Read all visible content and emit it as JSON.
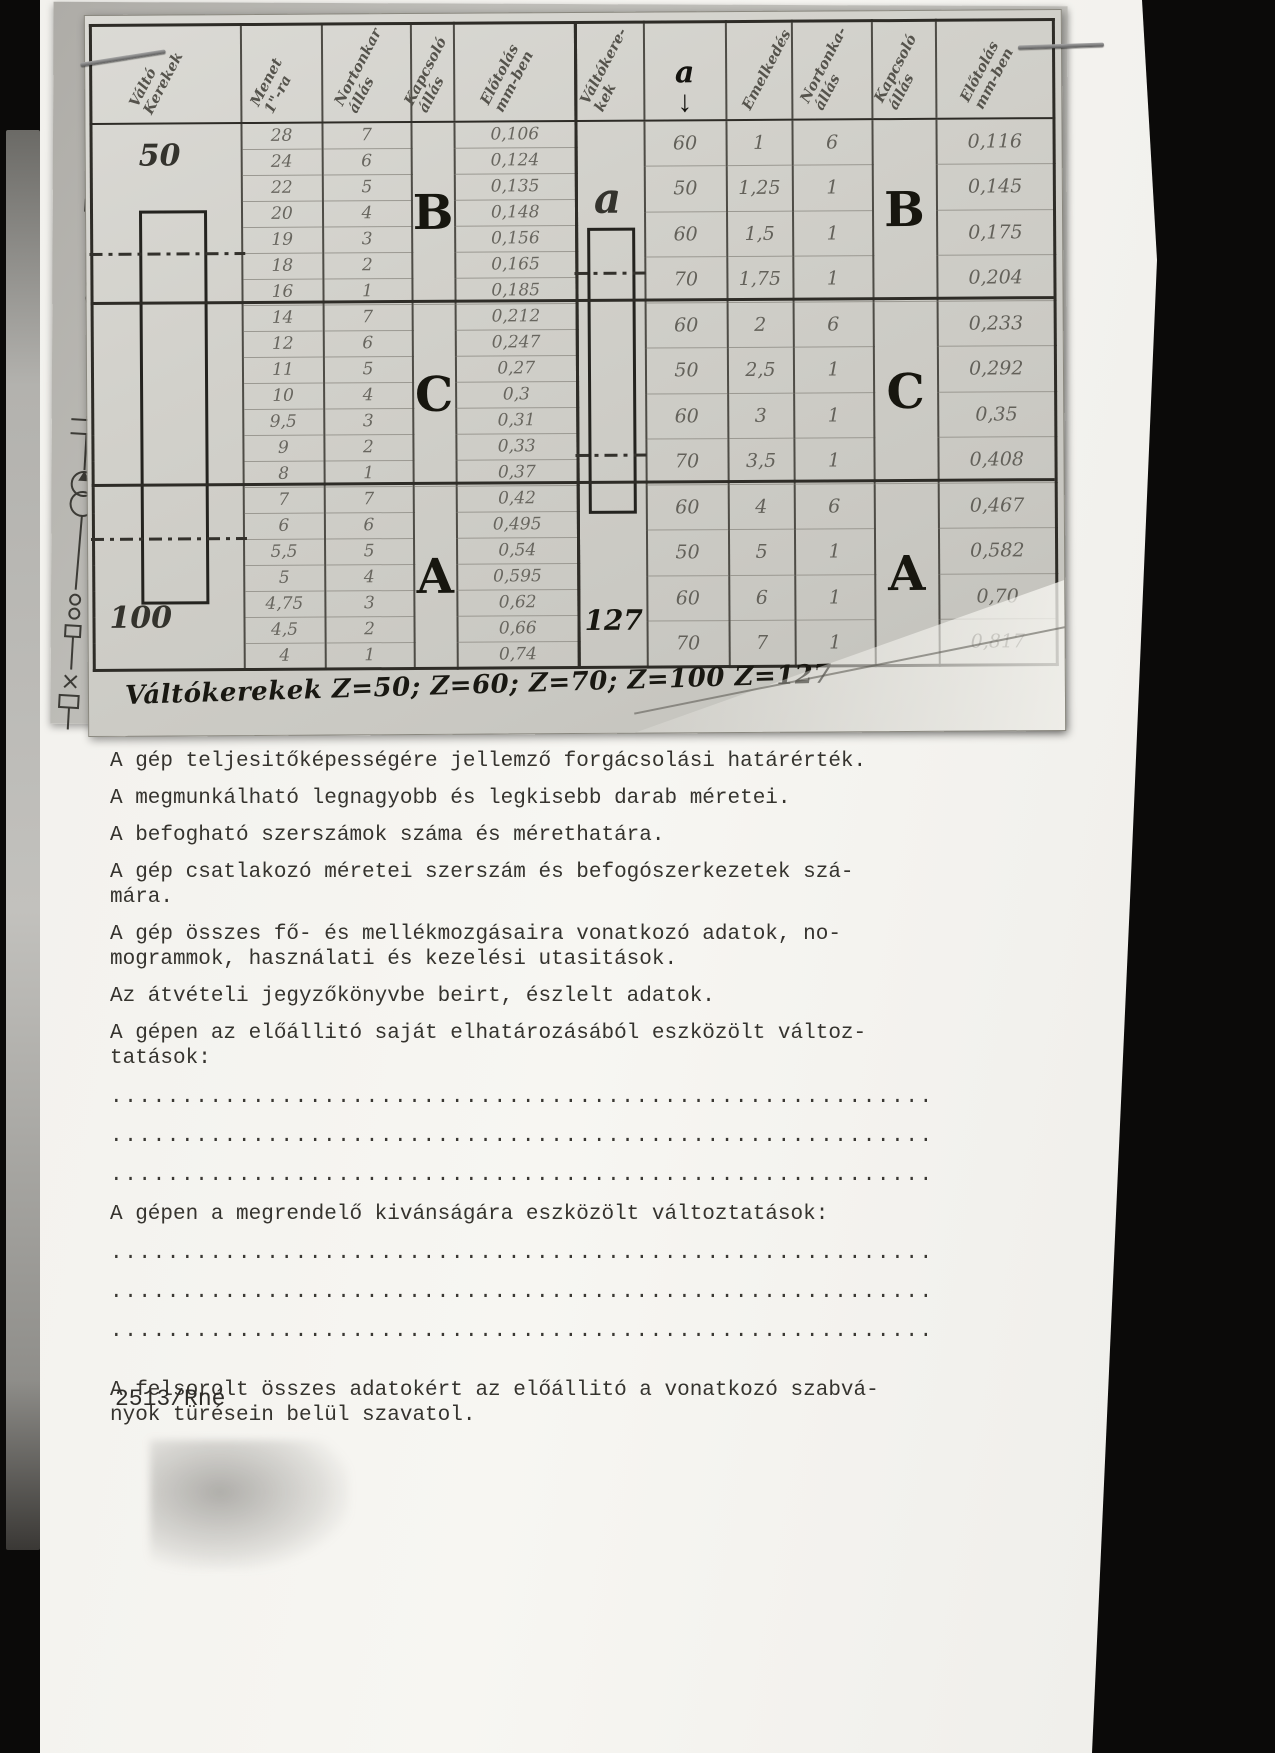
{
  "photo": {
    "caption": "Váltókerekek   Z=50;  Z=60;  Z=70;  Z=100   Z=127",
    "left_table": {
      "headers": [
        "Váltó\nKerekek",
        "Menet\n1\"-ra",
        "Nortonkar\nállás",
        "Kapcsoló\nállás",
        "Előtolás\nmm-ben"
      ],
      "gear_top": "50",
      "gear_bottom": "100",
      "groups": [
        {
          "letter": "B",
          "rows": [
            [
              "28",
              "7",
              "0,106"
            ],
            [
              "24",
              "6",
              "0,124"
            ],
            [
              "22",
              "5",
              "0,135"
            ],
            [
              "20",
              "4",
              "0,148"
            ],
            [
              "19",
              "3",
              "0,156"
            ],
            [
              "18",
              "2",
              "0,165"
            ],
            [
              "16",
              "1",
              "0,185"
            ]
          ]
        },
        {
          "letter": "C",
          "rows": [
            [
              "14",
              "7",
              "0,212"
            ],
            [
              "12",
              "6",
              "0,247"
            ],
            [
              "11",
              "5",
              "0,27"
            ],
            [
              "10",
              "4",
              "0,3"
            ],
            [
              "9,5",
              "3",
              "0,31"
            ],
            [
              "9",
              "2",
              "0,33"
            ],
            [
              "8",
              "1",
              "0,37"
            ]
          ]
        },
        {
          "letter": "A",
          "rows": [
            [
              "7",
              "7",
              "0,42"
            ],
            [
              "6",
              "6",
              "0,495"
            ],
            [
              "5,5",
              "5",
              "0,54"
            ],
            [
              "5",
              "4",
              "0,595"
            ],
            [
              "4,75",
              "3",
              "0,62"
            ],
            [
              "4,5",
              "2",
              "0,66"
            ],
            [
              "4",
              "1",
              "0,74"
            ]
          ]
        }
      ]
    },
    "right_table": {
      "headers": [
        "Váltókere-\nkek",
        "a",
        "Emelkedés",
        "Nortonka-\nállás",
        "Kapcsoló\nállás",
        "Előtolás\nmm-ben"
      ],
      "arrow_glyph": "↓",
      "gear_top": "a",
      "gear_bottom": "127",
      "groups": [
        {
          "letter": "B",
          "rows": [
            [
              "60",
              "1",
              "6",
              "0,116"
            ],
            [
              "50",
              "1,25",
              "1",
              "0,145"
            ],
            [
              "60",
              "1,5",
              "1",
              "0,175"
            ],
            [
              "70",
              "1,75",
              "1",
              "0,204"
            ]
          ]
        },
        {
          "letter": "C",
          "rows": [
            [
              "60",
              "2",
              "6",
              "0,233"
            ],
            [
              "50",
              "2,5",
              "1",
              "0,292"
            ],
            [
              "60",
              "3",
              "1",
              "0,35"
            ],
            [
              "70",
              "3,5",
              "1",
              "0,408"
            ]
          ]
        },
        {
          "letter": "A",
          "rows": [
            [
              "60",
              "4",
              "6",
              "0,467"
            ],
            [
              "50",
              "5",
              "1",
              "0,582"
            ],
            [
              "60",
              "6",
              "1",
              "0,70"
            ],
            [
              "70",
              "7",
              "1",
              "0,817"
            ]
          ]
        }
      ]
    }
  },
  "document": {
    "obscured_line": "Az esztorga villamos …",
    "items": [
      {
        "type": "p",
        "text": "A gép teljesitőképességére jellemző forgácsolási határérték."
      },
      {
        "type": "p",
        "text": "A megmunkálható legnagyobb és legkisebb darab méretei."
      },
      {
        "type": "p",
        "text": "A befogható szerszámok száma és mérethatára."
      },
      {
        "type": "p",
        "text": "A gép csatlakozó méretei szerszám és befogószerkezetek szá-\nmára."
      },
      {
        "type": "p",
        "text": "A gép összes fő- és mellékmozgásaira vonatkozó adatok, no-\nmogrammok, használati és kezelési utasitások."
      },
      {
        "type": "p",
        "text": "Az átvételi jegyzőkönyvbe beirt, észlelt adatok."
      },
      {
        "type": "p",
        "text": "A gépen az előállitó saját elhatározásából eszközölt változ-\ntatások:"
      },
      {
        "type": "dots",
        "count": 3
      },
      {
        "type": "p",
        "text": "A gépen a megrendelő kivánságára eszközölt változtatások:"
      },
      {
        "type": "dots",
        "count": 3
      },
      {
        "type": "p",
        "final": true,
        "text": "A felsorolt összes adatokért az előállitó a vonatkozó szabvá-\nnyok türésein belül szavatol."
      }
    ],
    "dotted_line": "..........................................................",
    "reference": "2513/Rné"
  },
  "icons": {
    "staple": "staple-icon",
    "schematic_fragment": "circuit-diagram-fragment",
    "schematic_label": "B"
  },
  "colors": {
    "scanner_background": "#0b0a09",
    "page": "#f5f4f0",
    "photo_paper": "#d2d1cb",
    "pencil": "#68665f",
    "ink": "#17160f",
    "typewriter": "#35332e"
  }
}
